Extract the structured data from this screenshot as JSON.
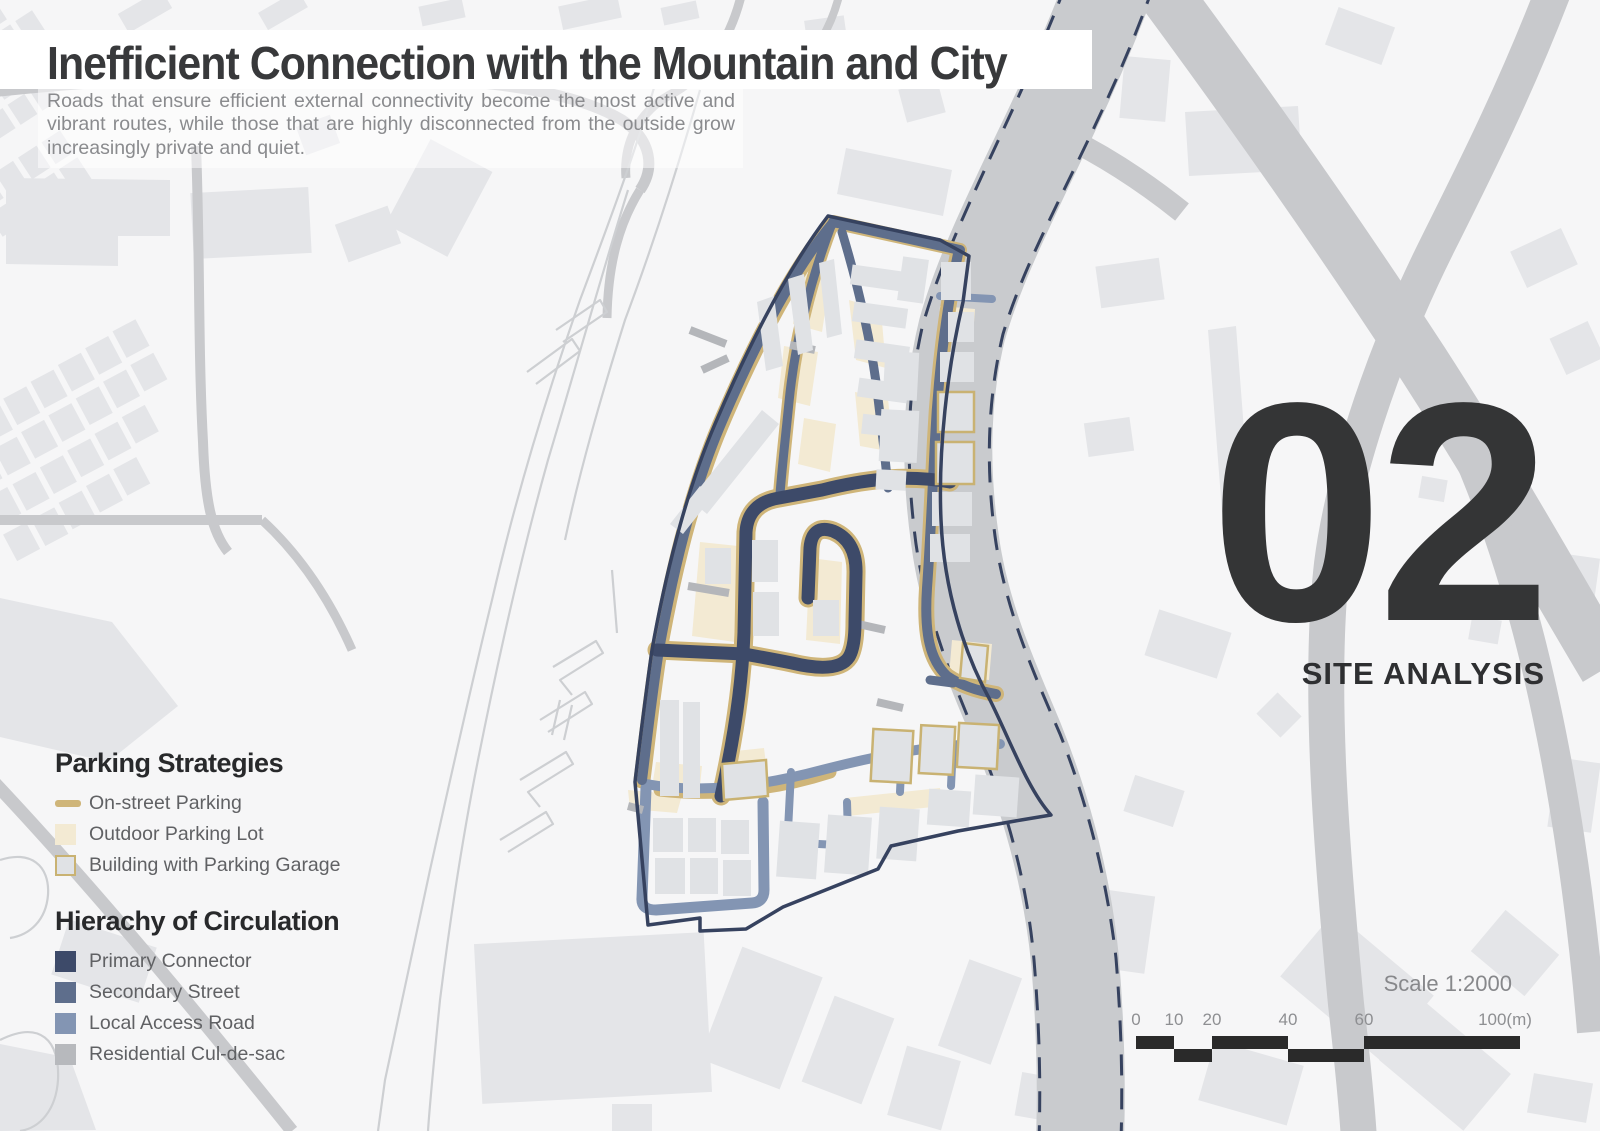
{
  "header": {
    "title": "Inefficient Connection with the Mountain and City",
    "subtitle": "Roads that ensure efficient external connectivity become the most active and vibrant routes, while those that are highly disconnected from the outside grow increasingly private and quiet."
  },
  "badge": {
    "number": "02",
    "label": "SITE ANALYSIS"
  },
  "legend": {
    "parking": {
      "heading": "Parking Strategies",
      "items": [
        {
          "label": "On-street Parking",
          "color": "#cfb579"
        },
        {
          "label": "Outdoor Parking Lot",
          "color": "#f3ead3"
        },
        {
          "label": "Building with Parking Garage",
          "color": "#e0e2e5",
          "border": "#c9b272"
        }
      ]
    },
    "circulation": {
      "heading": "Hierachy of Circulation",
      "items": [
        {
          "label": "Primary Connector",
          "color": "#3d4a69"
        },
        {
          "label": "Secondary Street",
          "color": "#5e6e8c"
        },
        {
          "label": "Local Access Road",
          "color": "#8395b3"
        },
        {
          "label": "Residential Cul-de-sac",
          "color": "#b7b9bd"
        }
      ]
    }
  },
  "scale": {
    "label": "Scale 1:2000",
    "ticks": [
      "0",
      "10",
      "20",
      "40",
      "60",
      "100(m)"
    ]
  },
  "map_colors": {
    "site_boundary": "#36425f",
    "city_road": "#c9cbce",
    "background_building": "#e4e5e8"
  }
}
